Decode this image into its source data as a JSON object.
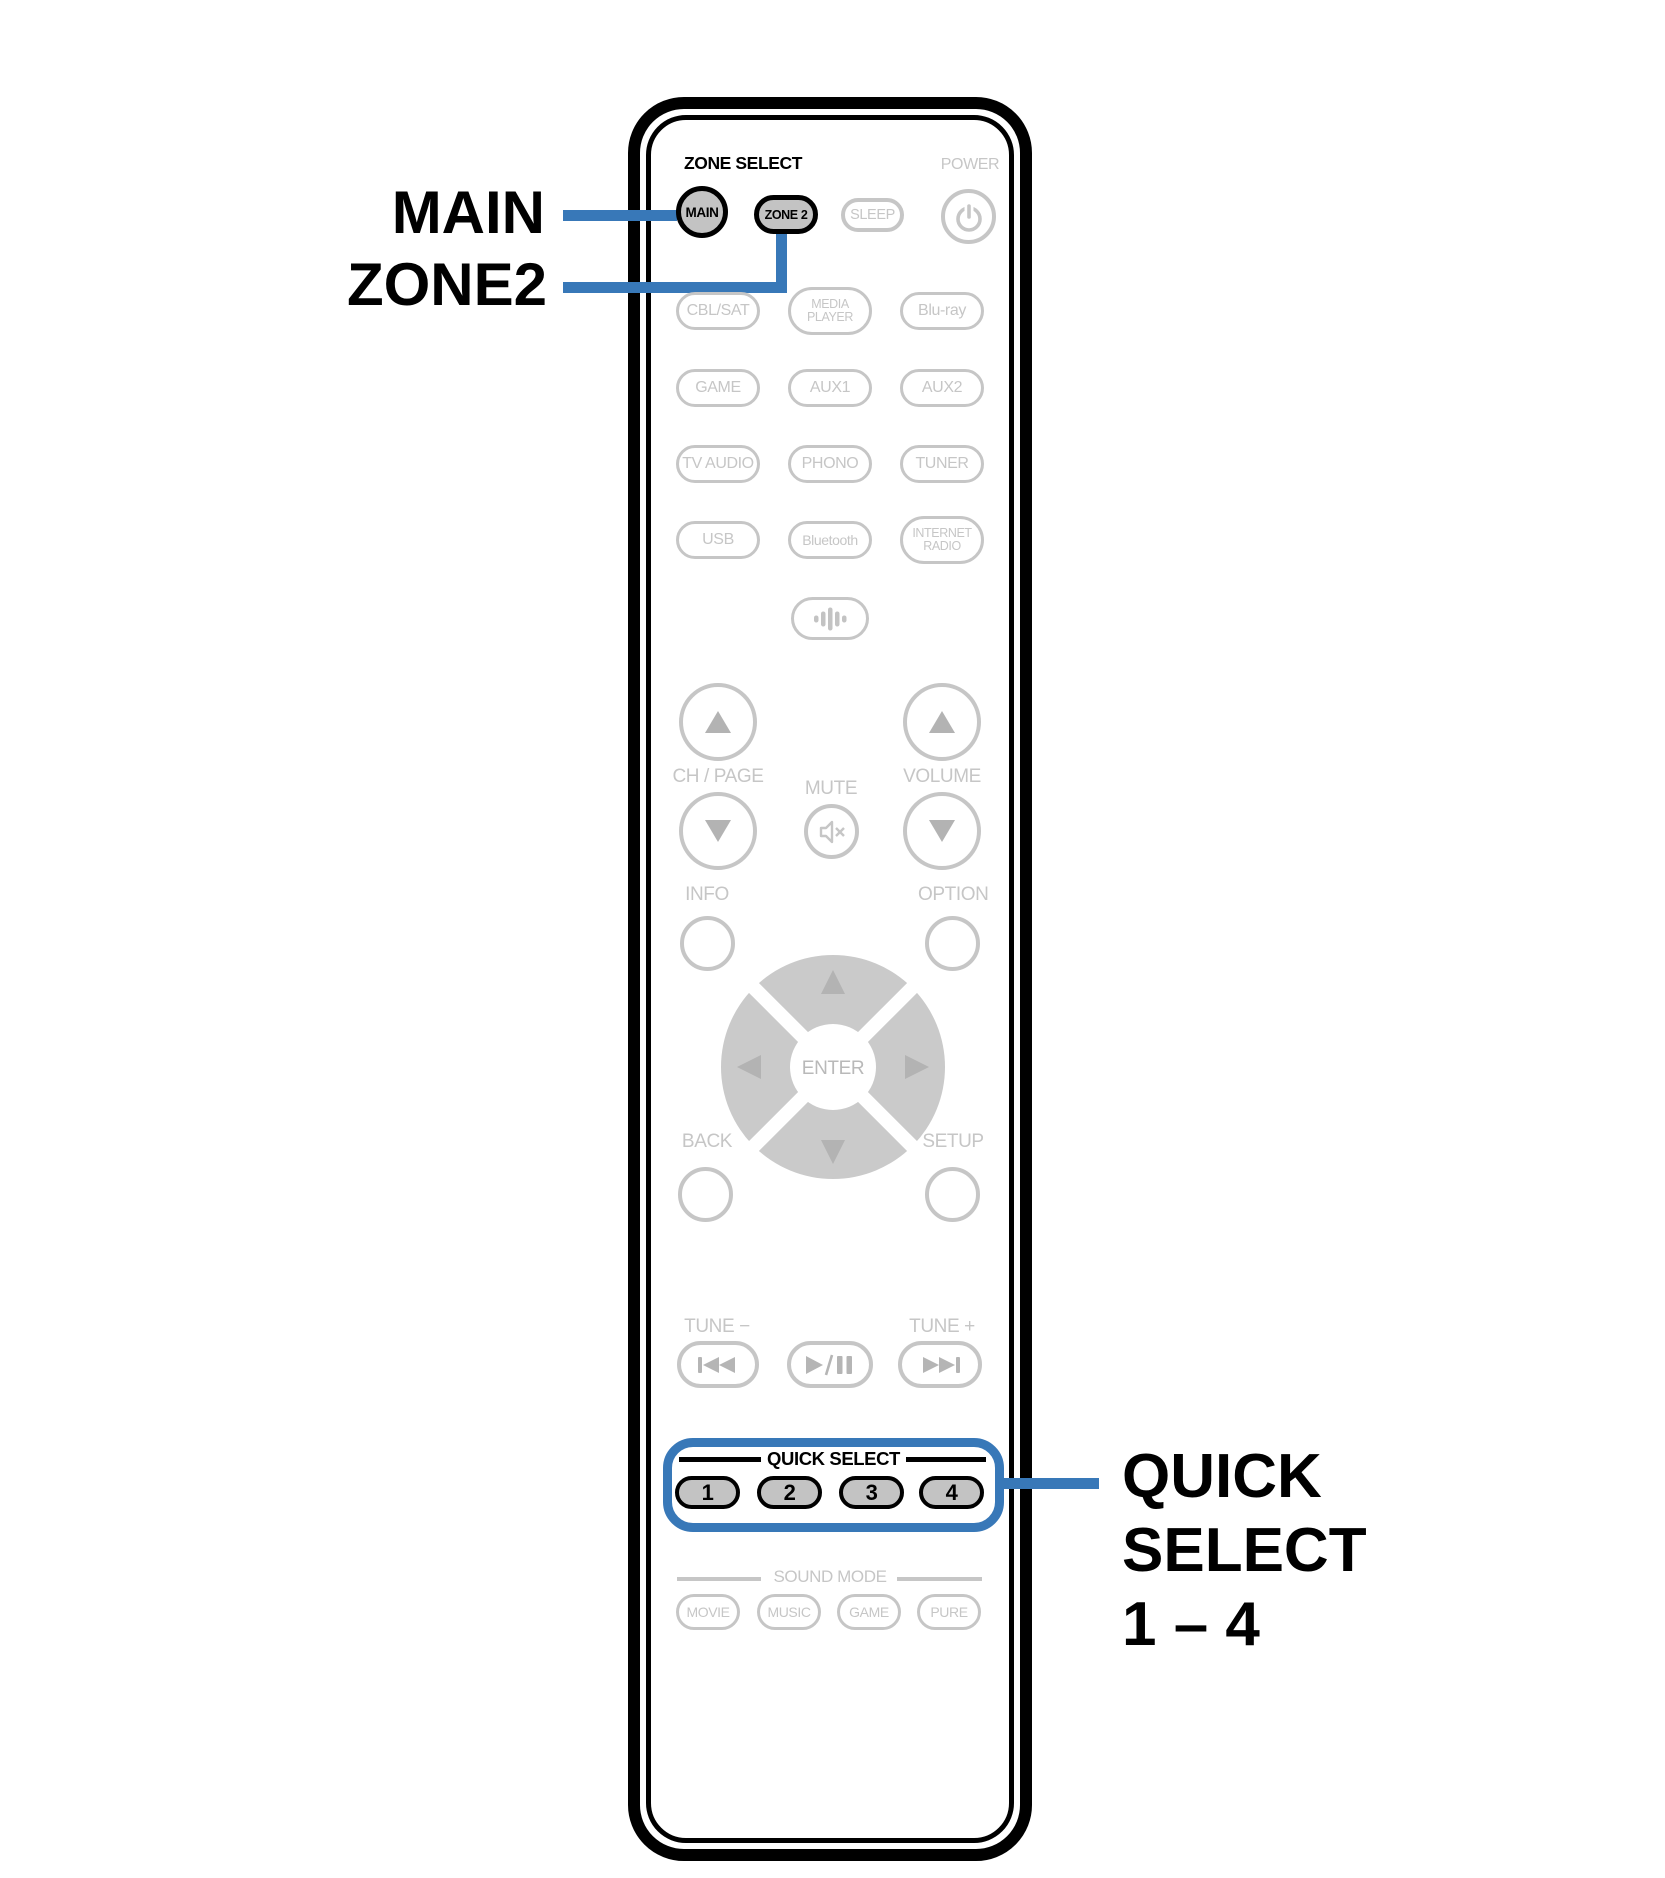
{
  "colors": {
    "blue": "#3878b8",
    "outline_gray": "#c6c6c6",
    "fill_gray": "#c3c3c3",
    "icon_gray": "#b3b3b3",
    "dpad_gray": "#cacaca",
    "black": "#000000"
  },
  "callouts": {
    "main": "MAIN",
    "zone2": "ZONE2",
    "quick_select_line1": "QUICK",
    "quick_select_line2": "SELECT",
    "quick_select_line3": "1 – 4"
  },
  "remote": {
    "zone_select_label": "ZONE SELECT",
    "power_label": "POWER",
    "main_button": "MAIN",
    "zone2_button": "ZONE 2",
    "sleep_button": "SLEEP",
    "sources": [
      "CBL/SAT",
      "MEDIA\nPLAYER",
      "Blu-ray",
      "GAME",
      "AUX1",
      "AUX2",
      "TV AUDIO",
      "PHONO",
      "TUNER",
      "USB",
      "Bluetooth",
      "INTERNET\nRADIO"
    ],
    "ch_page_label": "CH / PAGE",
    "mute_label": "MUTE",
    "volume_label": "VOLUME",
    "info_label": "INFO",
    "option_label": "OPTION",
    "enter_label": "ENTER",
    "back_label": "BACK",
    "setup_label": "SETUP",
    "tune_minus_label": "TUNE −",
    "tune_plus_label": "TUNE +",
    "quick_select_label": "QUICK SELECT",
    "quick_buttons": [
      "1",
      "2",
      "3",
      "4"
    ],
    "sound_mode_label": "SOUND MODE",
    "sound_mode_buttons": [
      "MOVIE",
      "MUSIC",
      "GAME",
      "PURE"
    ]
  }
}
